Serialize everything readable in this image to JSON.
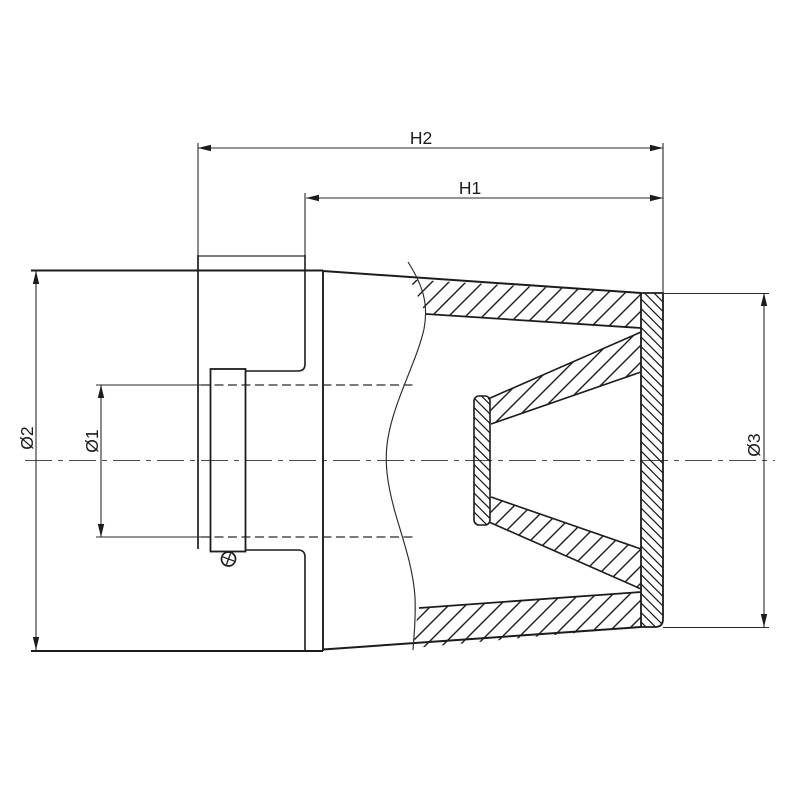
{
  "page": {
    "background": "#ffffff"
  },
  "drawing": {
    "type": "technical-drawing-air-filter-section",
    "colors": {
      "line": "#1c1c1c",
      "thin_line": "#2a2a2a",
      "centerline": "#4a4a4a"
    },
    "dimensions": {
      "h2": {
        "label": "H2"
      },
      "h1": {
        "label": "H1"
      },
      "d1": {
        "label": "Ø1"
      },
      "d2": {
        "label": "Ø2"
      },
      "d3": {
        "label": "Ø3"
      }
    }
  }
}
